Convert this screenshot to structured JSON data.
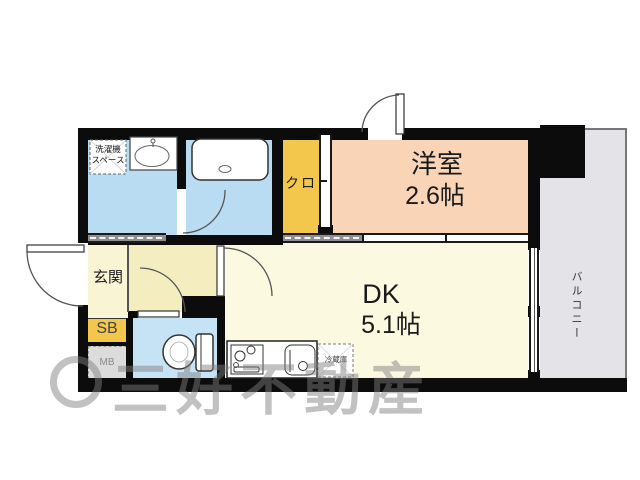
{
  "rooms": {
    "washer_space": {
      "line1": "洗濯機",
      "line2": "スペース"
    },
    "closet": {
      "label": "クロ"
    },
    "western_room": {
      "name": "洋室",
      "size": "2.6帖"
    },
    "dining_kitchen": {
      "name": "DK",
      "size": "5.1帖"
    },
    "entrance": {
      "label": "玄関"
    },
    "shoe_box": {
      "label": "SB"
    },
    "meter_box": {
      "label": "MB"
    },
    "balcony": {
      "label": "バルコニー"
    },
    "refrigerator": {
      "label": "冷蔵庫"
    }
  },
  "watermark": {
    "text": "三好不動産"
  },
  "colors": {
    "wall": "#0c0c0c",
    "wet_area_blue": "#b9dcf2",
    "toilet_blue": "#c6e3f6",
    "closet_yellow": "#f3c74b",
    "western_room_salmon": "#f9d4b6",
    "dk_cream": "#fbf9e0",
    "hall_cream": "#f3edc0",
    "entrance_cream": "#f9f4d4",
    "balcony_gray": "#e4e4e8",
    "meter_box_gray": "#dcdcdc"
  }
}
